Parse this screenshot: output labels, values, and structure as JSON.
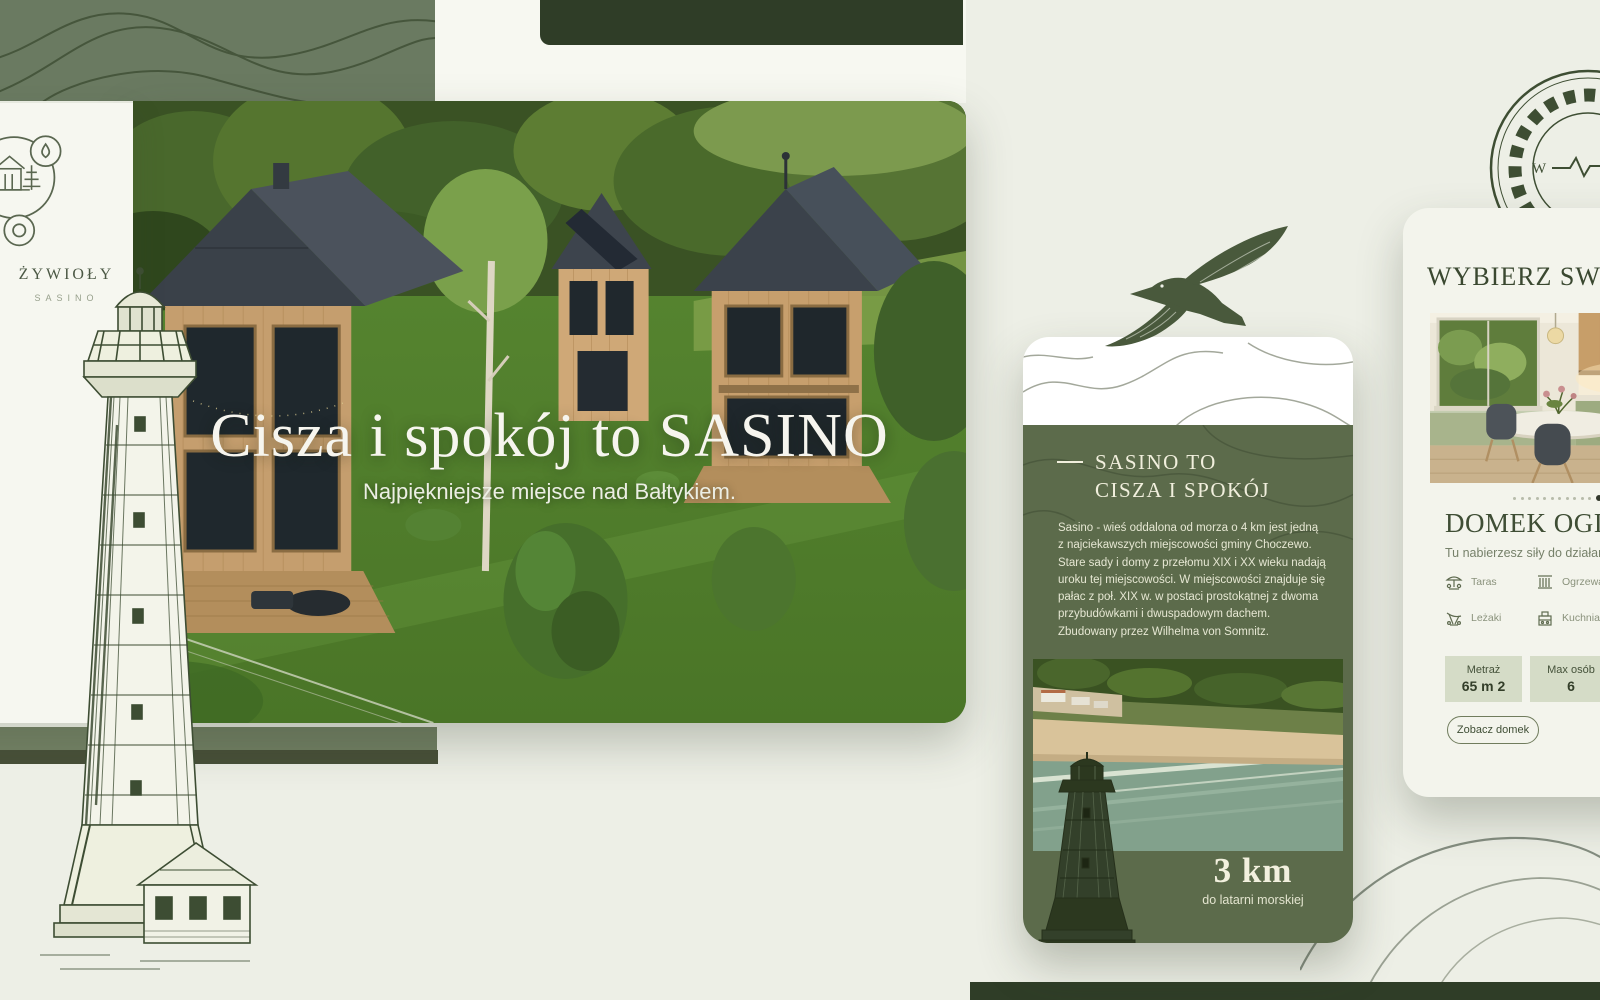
{
  "brand": {
    "logo_text": "ŻYWIOŁY",
    "logo_subtext": "SASINO"
  },
  "hero": {
    "title": "Cisza i spokój to SASINO",
    "subtitle": "Najpiękniejsze miejsce nad Bałtykiem."
  },
  "about_screen": {
    "heading_line1": "SASINO TO",
    "heading_line2": "CISZA I SPOKÓJ",
    "paragraph": "Sasino - wieś oddalona od morza o 4 km jest jedną z najciekawszych miejscowości gminy Choczewo. Stare sady i domy z przełomu XIX i XX wieku nadają uroku tej miejscowości. W miejscowości znajduje się pałac z poł. XIX w. w postaci prostokątnej z dwoma przybudówkami i dwuspadowym dachem. Zbudowany przez Wilhelma von Somnitz.",
    "distance_value": "3 km",
    "distance_label": "do latarni morskiej"
  },
  "chooser_screen": {
    "heading": "WYBIERZ SWÓJ",
    "house_card": {
      "name": "DOMEK OGIE",
      "tagline": "Tu nabierzesz siły do działania",
      "features": [
        {
          "icon": "terrace-icon",
          "label": "Taras"
        },
        {
          "icon": "radiator-icon",
          "label": "Ogrzewa"
        },
        {
          "icon": "deckchair-icon",
          "label": "Leżaki"
        },
        {
          "icon": "kitchen-icon",
          "label": "Kuchnia"
        }
      ],
      "stats": [
        {
          "label": "Metraż",
          "value": "65 m 2"
        },
        {
          "label": "Max osób",
          "value": "6"
        }
      ],
      "cta_label": "Zobacz domek",
      "carousel": {
        "dot_count": 13,
        "active_index": 11
      }
    }
  },
  "stamp": {
    "compass_letter": "W"
  },
  "colors": {
    "background": "#edefe6",
    "sage_block": "#6a7a61",
    "dark_bar": "#2f3d27",
    "olive_panel": "#5c6b4b",
    "cream_text": "#f0efdf",
    "ink_green": "#3f4e35",
    "stat_box": "#d5dcc7",
    "bottom_sage_bar": "#717f63",
    "bottom_dark_bar": "#474f38"
  }
}
